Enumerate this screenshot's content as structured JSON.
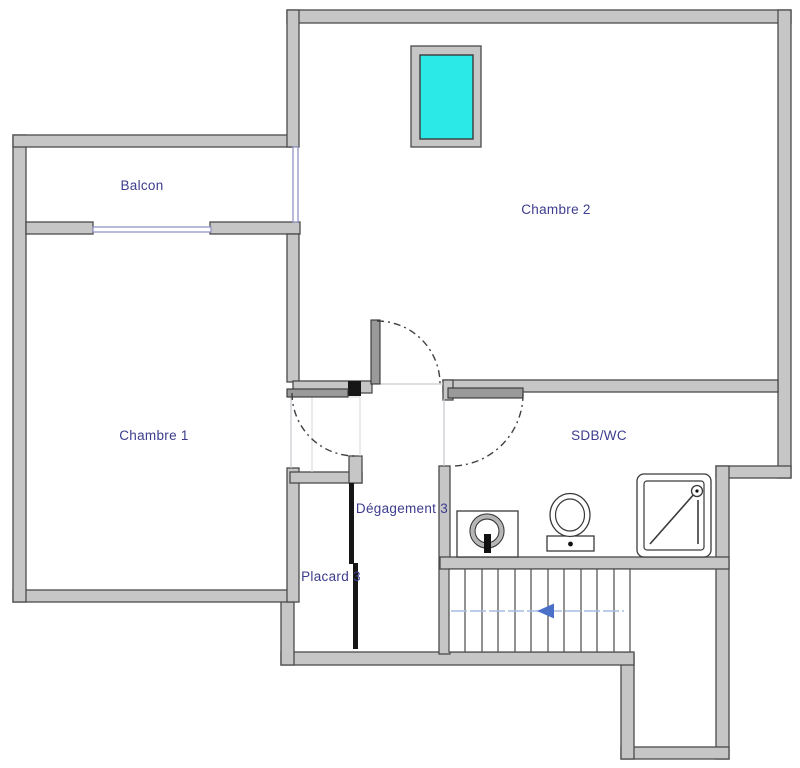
{
  "plan": {
    "type": "floor-plan",
    "level": "étage"
  },
  "rooms": {
    "balcon": {
      "label": "Balcon"
    },
    "chambre1": {
      "label": "Chambre 1"
    },
    "chambre2": {
      "label": "Chambre 2"
    },
    "sdb_wc": {
      "label": "SDB/WC"
    },
    "degagement": {
      "label": "Dégagement 3"
    },
    "placard": {
      "label": "Placard 3"
    }
  },
  "fixtures": {
    "sink": "lavabo",
    "toilet": "wc",
    "shower": "douche",
    "velux": "fenêtre de toit",
    "stairs_direction": "left"
  },
  "colors": {
    "wall_fill": "#c6c6c6",
    "wall_edge": "#4a4a4a",
    "door_leaf": "#9a9a9a",
    "door_arc": "#3f3f3f",
    "label_text": "#3c3c8e",
    "window_glass": "#2be9e7",
    "window_line": "#9395c6",
    "fixture_line": "#3a3a3a",
    "stairs_guide": "#a9bce2",
    "stairs_arrow": "#4a70c8"
  }
}
